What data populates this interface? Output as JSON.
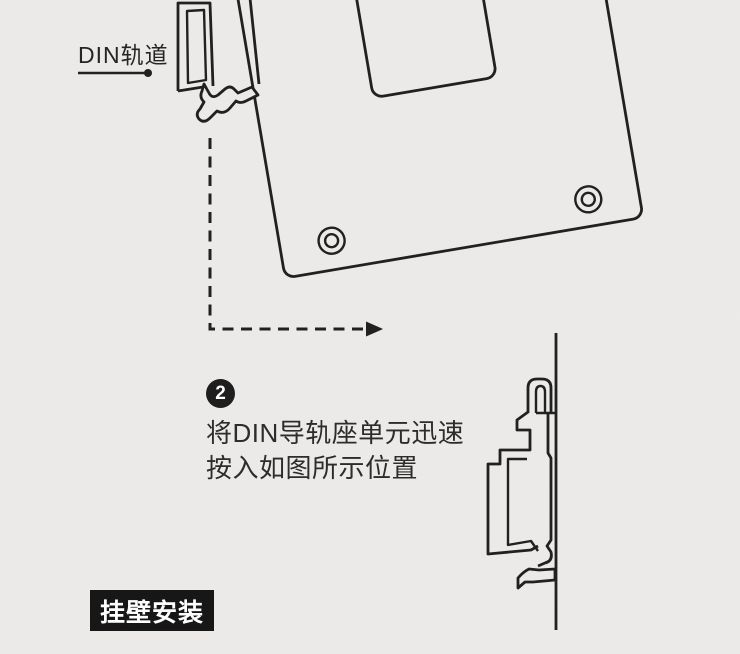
{
  "page": {
    "type": "product-installation-manual-illustration",
    "colors": {
      "background": "#ECEBE9",
      "line_ink": "#1E1E1E",
      "step_badge_bg": "#1B1B1B",
      "section_label_bg": "#141414",
      "section_label_text": "#FFFFFF",
      "body_text": "#2A2A2A"
    }
  },
  "annotations": {
    "din_rail_label": "DIN轨道",
    "section_label": "挂壁安装"
  },
  "step": {
    "number": "2",
    "instruction_line1": "将DIN导轨座单元迅速",
    "instruction_line2": "按入如图所示位置"
  },
  "figures": {
    "top_illustration": "tilted mounting plate snapping onto DIN rail (front view, two screw holes, rectangular cutout)",
    "motion_hint": "dashed L-shaped arrow pointing right",
    "right_illustration": "DIN rail clip side profile hooked on wall line"
  },
  "icons": [
    "din-rail-cross-section-icon",
    "mount-plate-icon",
    "screw-hole-icon",
    "dashed-arrow-icon",
    "wall-clip-side-view-icon",
    "leader-dot-icon"
  ]
}
